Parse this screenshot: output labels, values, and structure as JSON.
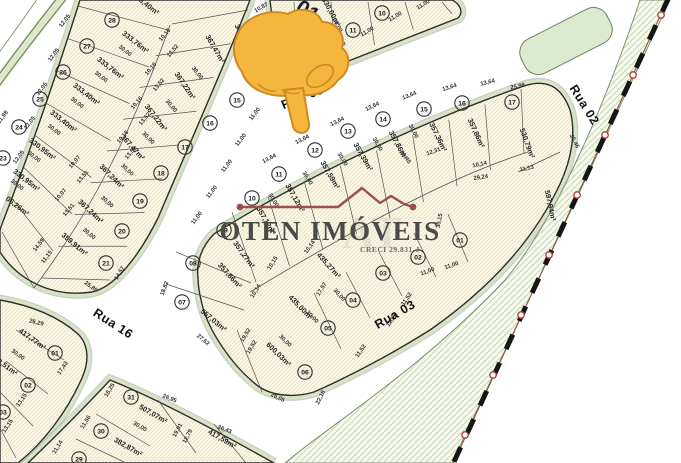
{
  "map": {
    "kind": "subdivision-plan",
    "colors": {
      "lot_fill": "#faf7e5",
      "lot_hatch": "#ebe1bb",
      "curb_band": "#d9e4c6",
      "curb_outer": "#95a583",
      "outline": "#2e2e2e",
      "green_area_fill": "#f5f9ee",
      "green_area_hatch": "#c9dcab",
      "island_fill": "#dcead0",
      "island_line": "#70805c",
      "boundary_dash": "#161616",
      "boundary_node": "#b23b2e",
      "boundary_wire": "#8a4a3c",
      "pointer_fill": "#f6b63e",
      "pointer_stroke": "#cf8a1f",
      "watermark_line": "#9a4f49"
    }
  },
  "watermark": {
    "brand": "OTEN IMÓVEIS",
    "creci": "CRECI 29.831-J",
    "monogram": "AT"
  },
  "pointer": {
    "icon": "hand-pointing-down",
    "tip_x": 300,
    "tip_y": 132
  },
  "quadra_label": {
    "text": "01",
    "x": 304,
    "y": 17,
    "rot": 33
  },
  "streets": [
    {
      "name": "Rua 05",
      "x": 304,
      "y": 101,
      "rot": -22
    },
    {
      "name": "Rua 02",
      "x": 581,
      "y": 107,
      "rot": 58
    },
    {
      "name": "Rua 16",
      "x": 111,
      "y": 327,
      "rot": 33
    },
    {
      "name": "Rua 03",
      "x": 397,
      "y": 318,
      "rot": -30
    }
  ],
  "blocks": [
    {
      "id": "quadra-oeste",
      "lots": [
        {
          "n": "28",
          "cx": 112,
          "cy": 20,
          "area": "333,76m²",
          "ax": 134,
          "ay": 44,
          "rot": 38
        },
        {
          "n": "27",
          "cx": 87,
          "cy": 46,
          "area": "333,76m²",
          "ax": 109,
          "ay": 70,
          "rot": 38
        },
        {
          "n": "26",
          "cx": 63,
          "cy": 72,
          "area": "333,40m²",
          "ax": 85,
          "ay": 96,
          "rot": 38
        },
        {
          "n": "25",
          "cx": 40,
          "cy": 99,
          "area": "333,40m²",
          "ax": 62,
          "ay": 123,
          "rot": 38
        },
        {
          "n": "24",
          "cx": 19,
          "cy": 127,
          "area": "330,95m²",
          "ax": 41,
          "ay": 151,
          "rot": 38
        },
        {
          "n": "23",
          "cx": 3,
          "cy": 158,
          "area": "330,95m²",
          "ax": 25,
          "ay": 182,
          "rot": 38
        },
        {
          "n": "",
          "area": "06,26m²",
          "ax": 16,
          "ay": 208,
          "rot": 38
        },
        {
          "n": "",
          "area": "33,40m²",
          "ax": 146,
          "ay": 7,
          "rot": 38
        },
        {
          "n": "",
          "area": "349,58m²",
          "ax": 240,
          "ay": 40,
          "rot": 70
        },
        {
          "n": "15",
          "cx": 237,
          "cy": 100,
          "area": "367,47m²",
          "ax": 213,
          "ay": 50,
          "rot": 60
        },
        {
          "n": "16",
          "cx": 210,
          "cy": 123,
          "area": "367,22m²",
          "ax": 183,
          "ay": 87,
          "rot": 56
        },
        {
          "n": "17",
          "cx": 185,
          "cy": 147,
          "area": "367,22m²",
          "ax": 154,
          "ay": 119,
          "rot": 52
        },
        {
          "n": "18",
          "cx": 161,
          "cy": 173,
          "area": "367,47m²",
          "ax": 131,
          "ay": 149,
          "rot": 48
        },
        {
          "n": "19",
          "cx": 140,
          "cy": 201,
          "area": "367,24m²",
          "ax": 110,
          "ay": 178,
          "rot": 45
        },
        {
          "n": "20",
          "cx": 122,
          "cy": 231,
          "area": "367,24m²",
          "ax": 89,
          "ay": 213,
          "rot": 43
        },
        {
          "n": "21",
          "cx": 106,
          "cy": 263,
          "area": "359,91m²",
          "ax": 73,
          "ay": 246,
          "rot": 40
        }
      ],
      "measurements": [
        {
          "t": "12,05",
          "x": 66,
          "y": 22,
          "rot": -52
        },
        {
          "t": "12,05",
          "x": 55,
          "y": 56,
          "rot": -52
        },
        {
          "t": "12,05",
          "x": 43,
          "y": 90,
          "rot": -52
        },
        {
          "t": "12,05",
          "x": 31,
          "y": 124,
          "rot": -52
        },
        {
          "t": "12,05",
          "x": 20,
          "y": 158,
          "rot": -54
        },
        {
          "t": "11,98",
          "x": 4,
          "y": 118,
          "rot": -54
        },
        {
          "t": "30,00",
          "x": 124,
          "y": 52,
          "rot": 38
        },
        {
          "t": "30,00",
          "x": 100,
          "y": 78,
          "rot": 38
        },
        {
          "t": "30,00",
          "x": 76,
          "y": 104,
          "rot": 38
        },
        {
          "t": "30,00",
          "x": 53,
          "y": 131,
          "rot": 38
        },
        {
          "t": "30,00",
          "x": 33,
          "y": 158,
          "rot": 38
        },
        {
          "t": "30,00",
          "x": 16,
          "y": 186,
          "rot": 38
        },
        {
          "t": "10,16",
          "x": 166,
          "y": 36,
          "rot": -50
        },
        {
          "t": "13,52",
          "x": 174,
          "y": 52,
          "rot": -50
        },
        {
          "t": "10,16",
          "x": 152,
          "y": 70,
          "rot": -50
        },
        {
          "t": "13,52",
          "x": 160,
          "y": 86,
          "rot": -50
        },
        {
          "t": "10,16",
          "x": 138,
          "y": 104,
          "rot": -50
        },
        {
          "t": "13,52",
          "x": 146,
          "y": 120,
          "rot": -50
        },
        {
          "t": "10,16",
          "x": 124,
          "y": 138,
          "rot": -50
        },
        {
          "t": "13,52",
          "x": 132,
          "y": 154,
          "rot": -50
        },
        {
          "t": "10,07",
          "x": 76,
          "y": 163,
          "rot": -50
        },
        {
          "t": "13,51",
          "x": 84,
          "y": 178,
          "rot": -50
        },
        {
          "t": "10,07",
          "x": 62,
          "y": 196,
          "rot": -50
        },
        {
          "t": "13,51",
          "x": 70,
          "y": 211,
          "rot": -50
        },
        {
          "t": "14,59",
          "x": 40,
          "y": 246,
          "rot": -52
        },
        {
          "t": "11,15",
          "x": 48,
          "y": 258,
          "rot": -52
        },
        {
          "t": "25,89",
          "x": 90,
          "y": 288,
          "rot": 36
        },
        {
          "t": "14,57",
          "x": 121,
          "y": 274,
          "rot": -58
        },
        {
          "t": "11,00",
          "x": 256,
          "y": 115,
          "rot": -52
        },
        {
          "t": "11,00",
          "x": 242,
          "y": 141,
          "rot": -52
        },
        {
          "t": "11,00",
          "x": 228,
          "y": 167,
          "rot": -52
        },
        {
          "t": "11,00",
          "x": 213,
          "y": 193,
          "rot": -52
        },
        {
          "t": "11,00",
          "x": 198,
          "y": 219,
          "rot": -52
        },
        {
          "t": "30,00",
          "x": 196,
          "y": 74,
          "rot": 52
        },
        {
          "t": "30,00",
          "x": 170,
          "y": 107,
          "rot": 49
        },
        {
          "t": "30,00",
          "x": 147,
          "y": 139,
          "rot": 46
        },
        {
          "t": "30,00",
          "x": 126,
          "y": 171,
          "rot": 44
        },
        {
          "t": "30,00",
          "x": 106,
          "y": 203,
          "rot": 42
        },
        {
          "t": "30,00",
          "x": 88,
          "y": 235,
          "rot": 40
        }
      ]
    },
    {
      "id": "quadra-01",
      "lots": [
        {
          "n": "12",
          "cx": 325,
          "cy": 45,
          "area": "330,00m²",
          "ax": 300,
          "ay": 30,
          "rot": 62
        },
        {
          "n": "11",
          "cx": 353,
          "cy": 30,
          "area": "330,00m²",
          "ax": 329,
          "ay": 13,
          "rot": 62
        },
        {
          "n": "10",
          "cx": 382,
          "cy": 13,
          "area": "",
          "ax": 0,
          "ay": 0,
          "rot": 0
        }
      ],
      "measurements": [
        {
          "t": "11,00",
          "x": 312,
          "y": 63,
          "rot": -30
        },
        {
          "t": "11,00",
          "x": 340,
          "y": 48,
          "rot": -30
        },
        {
          "t": "11,00",
          "x": 368,
          "y": 33,
          "rot": -30
        },
        {
          "t": "11,00",
          "x": 396,
          "y": 18,
          "rot": -30
        },
        {
          "t": "11,00",
          "x": 424,
          "y": 6,
          "rot": -30
        },
        {
          "t": "10,87",
          "x": 262,
          "y": 9,
          "rot": -30
        },
        {
          "t": "30,00",
          "x": 307,
          "y": 42,
          "rot": 62
        },
        {
          "t": "30,00",
          "x": 336,
          "y": 26,
          "rot": 62
        }
      ]
    },
    {
      "id": "quadra-central",
      "lots": [
        {
          "n": "10",
          "cx": 252,
          "cy": 198,
          "area": "357,12m²",
          "ax": 264,
          "ay": 222,
          "rot": 60
        },
        {
          "n": "11",
          "cx": 279,
          "cy": 174,
          "area": "357,12m²",
          "ax": 293,
          "ay": 199,
          "rot": 60
        },
        {
          "n": "12",
          "cx": 315,
          "cy": 150,
          "area": "357,59m²",
          "ax": 328,
          "ay": 176,
          "rot": 60
        },
        {
          "n": "13",
          "cx": 348,
          "cy": 131,
          "area": "357,39m²",
          "ax": 361,
          "ay": 158,
          "rot": 60
        },
        {
          "n": "14",
          "cx": 383,
          "cy": 119,
          "area": "357,86m²",
          "ax": 396,
          "ay": 146,
          "rot": 62
        },
        {
          "n": "15",
          "cx": 424,
          "cy": 109,
          "area": "357,36m²",
          "ax": 436,
          "ay": 138,
          "rot": 64
        },
        {
          "n": "16",
          "cx": 462,
          "cy": 103,
          "area": "357,86m²",
          "ax": 474,
          "ay": 134,
          "rot": 66
        },
        {
          "n": "17",
          "cx": 512,
          "cy": 102,
          "area": "530,79m²",
          "ax": 525,
          "ay": 144,
          "rot": 70
        },
        {
          "n": "01",
          "cx": 460,
          "cy": 240,
          "area": "597,94m²",
          "ax": 548,
          "ay": 206,
          "rot": 78
        },
        {
          "n": "02",
          "cx": 418,
          "cy": 257,
          "area": "",
          "ax": 0,
          "ay": 0,
          "rot": 0
        },
        {
          "n": "03",
          "cx": 383,
          "cy": 273,
          "area": "",
          "ax": 0,
          "ay": 0,
          "rot": 0
        },
        {
          "n": "04",
          "cx": 353,
          "cy": 300,
          "area": "435,27m²",
          "ax": 327,
          "ay": 267,
          "rot": 48
        },
        {
          "n": "05",
          "cx": 328,
          "cy": 328,
          "area": "435,00m²",
          "ax": 299,
          "ay": 309,
          "rot": 46
        },
        {
          "n": "06",
          "cx": 305,
          "cy": 372,
          "area": "600,03m²",
          "ax": 277,
          "ay": 356,
          "rot": 44
        },
        {
          "n": "07",
          "cx": 182,
          "cy": 302,
          "area": "557,03m²",
          "ax": 212,
          "ay": 322,
          "rot": 40
        },
        {
          "n": "08",
          "cx": 193,
          "cy": 263,
          "area": "357,86m²",
          "ax": 228,
          "ay": 277,
          "rot": 48
        },
        {
          "n": "09",
          "cx": 224,
          "cy": 230,
          "area": "357,27m²",
          "ax": 242,
          "ay": 256,
          "rot": 54
        }
      ],
      "measurements": [
        {
          "t": "13,64",
          "x": 270,
          "y": 160,
          "rot": -28
        },
        {
          "t": "13,64",
          "x": 303,
          "y": 141,
          "rot": -27
        },
        {
          "t": "13,64",
          "x": 338,
          "y": 123,
          "rot": -26
        },
        {
          "t": "13,64",
          "x": 373,
          "y": 108,
          "rot": -25
        },
        {
          "t": "13,64",
          "x": 410,
          "y": 97,
          "rot": -22
        },
        {
          "t": "13,64",
          "x": 450,
          "y": 89,
          "rot": -18
        },
        {
          "t": "13,64",
          "x": 488,
          "y": 84,
          "rot": -14
        },
        {
          "t": "25,98",
          "x": 518,
          "y": 88,
          "rot": -12
        },
        {
          "t": "25,46",
          "x": 573,
          "y": 142,
          "rot": 62
        },
        {
          "t": "29,24",
          "x": 481,
          "y": 179,
          "rot": -8
        },
        {
          "t": "11,13",
          "x": 527,
          "y": 170,
          "rot": -12
        },
        {
          "t": "10,14",
          "x": 480,
          "y": 166,
          "rot": -12
        },
        {
          "t": "12,31",
          "x": 434,
          "y": 153,
          "rot": -20
        },
        {
          "t": "20,45",
          "x": 404,
          "y": 158,
          "rot": 55
        },
        {
          "t": "30,15",
          "x": 441,
          "y": 221,
          "rot": -80
        },
        {
          "t": "10,15",
          "x": 274,
          "y": 264,
          "rot": -58
        },
        {
          "t": "10,14",
          "x": 257,
          "y": 292,
          "rot": -58
        },
        {
          "t": "10,14",
          "x": 311,
          "y": 248,
          "rot": -55
        },
        {
          "t": "17,57",
          "x": 323,
          "y": 290,
          "rot": -58
        },
        {
          "t": "19,52",
          "x": 247,
          "y": 336,
          "rot": -58
        },
        {
          "t": "19,52",
          "x": 253,
          "y": 348,
          "rot": -58
        },
        {
          "t": "27,62",
          "x": 202,
          "y": 341,
          "rot": 40
        },
        {
          "t": "18,82",
          "x": 166,
          "y": 289,
          "rot": -70
        },
        {
          "t": "26,05",
          "x": 277,
          "y": 399,
          "rot": 26
        },
        {
          "t": "22,18",
          "x": 322,
          "y": 398,
          "rot": -64
        },
        {
          "t": "11,52",
          "x": 393,
          "y": 321,
          "rot": -55
        },
        {
          "t": "11,52",
          "x": 362,
          "y": 352,
          "rot": -55
        },
        {
          "t": "11,52",
          "x": 408,
          "y": 300,
          "rot": -55
        },
        {
          "t": "11,00",
          "x": 452,
          "y": 267,
          "rot": -18
        },
        {
          "t": "11,00",
          "x": 428,
          "y": 273,
          "rot": -20
        },
        {
          "t": "30,00",
          "x": 272,
          "y": 201,
          "rot": 58
        },
        {
          "t": "30,00",
          "x": 306,
          "y": 179,
          "rot": 58
        },
        {
          "t": "30,00",
          "x": 341,
          "y": 160,
          "rot": 58
        },
        {
          "t": "30,00",
          "x": 376,
          "y": 145,
          "rot": 60
        },
        {
          "t": "30,00",
          "x": 412,
          "y": 132,
          "rot": 62
        },
        {
          "t": "30,00",
          "x": 311,
          "y": 318,
          "rot": 46
        },
        {
          "t": "30,00",
          "x": 284,
          "y": 342,
          "rot": 44
        },
        {
          "t": "30,00",
          "x": 338,
          "y": 296,
          "rot": 48
        }
      ]
    },
    {
      "id": "quadra-sudoeste",
      "lots": [
        {
          "n": "01",
          "cx": 55,
          "cy": 353,
          "area": "417,77m²",
          "ax": 31,
          "ay": 341,
          "rot": 36
        },
        {
          "n": "02",
          "cx": 28,
          "cy": 385,
          "area": "8,51m²",
          "ax": 6,
          "ay": 369,
          "rot": 36
        },
        {
          "n": "03",
          "cx": 3,
          "cy": 412,
          "area": "",
          "ax": 0,
          "ay": 0,
          "rot": 0
        }
      ],
      "measurements": [
        {
          "t": "26,29",
          "x": 36,
          "y": 324,
          "rot": 14
        },
        {
          "t": "30,00",
          "x": 17,
          "y": 356,
          "rot": 36
        },
        {
          "t": "17,43",
          "x": 64,
          "y": 369,
          "rot": -56
        },
        {
          "t": "13,15",
          "x": 23,
          "y": 401,
          "rot": -56
        },
        {
          "t": "13,15",
          "x": 9,
          "y": 427,
          "rot": -56
        }
      ]
    },
    {
      "id": "quadra-sul",
      "lots": [
        {
          "n": "31",
          "cx": 131,
          "cy": 397,
          "area": "507,07m²",
          "ax": 152,
          "ay": 416,
          "rot": 30
        },
        {
          "n": "30",
          "cx": 101,
          "cy": 431,
          "area": "382,87m²",
          "ax": 127,
          "ay": 449,
          "rot": 30
        },
        {
          "n": "29",
          "cx": 79,
          "cy": 459,
          "area": "",
          "ax": 0,
          "ay": 0,
          "rot": 0
        },
        {
          "n": "",
          "area": "417,59m²",
          "ax": 221,
          "ay": 441,
          "rot": 30
        }
      ],
      "measurements": [
        {
          "t": "26,95",
          "x": 169,
          "y": 400,
          "rot": 22
        },
        {
          "t": "30,00",
          "x": 139,
          "y": 428,
          "rot": 30
        },
        {
          "t": "16,25",
          "x": 111,
          "y": 391,
          "rot": -58
        },
        {
          "t": "11,56",
          "x": 87,
          "y": 423,
          "rot": -58
        },
        {
          "t": "11,14",
          "x": 59,
          "y": 448,
          "rot": -58
        },
        {
          "t": "19,01",
          "x": 179,
          "y": 431,
          "rot": -62
        },
        {
          "t": "12,79",
          "x": 189,
          "y": 437,
          "rot": -62
        },
        {
          "t": "26,43",
          "x": 224,
          "y": 431,
          "rot": 22
        }
      ]
    }
  ]
}
